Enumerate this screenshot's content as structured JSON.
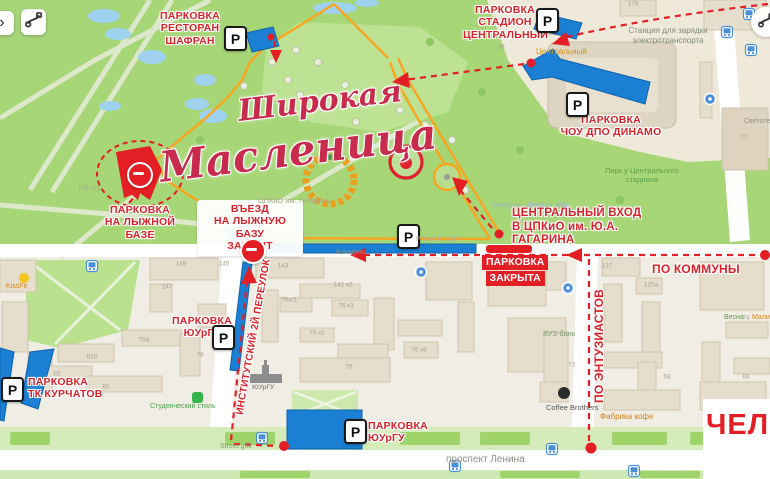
{
  "colors": {
    "annotation_red": "#d8232a",
    "parking_blue": "#1b7fd3",
    "route_orange": "#f9a51d",
    "park_green": "#a7d677",
    "closed_red": "#e31e24",
    "water_blue": "#9ed2ef"
  },
  "controls": {
    "chevron": "›"
  },
  "icons": {
    "parking": "P"
  },
  "logo": {
    "line1": "Широкая",
    "line2": "Масленица"
  },
  "annotations": {
    "parking_shafran": {
      "text": "ПАРКОВКА\nРЕСТОРАН\nШАФРАН"
    },
    "parking_stadium": {
      "text": "ПАРКОВКА\nСТАДИОН\nЦЕНТРАЛЬНЫЙ"
    },
    "parking_dinamo": {
      "text": "ПАРКОВКА\nЧОУ ДПО ДИНАМО"
    },
    "parking_ski": {
      "text": "ПАРКОВКА\nНА ЛЫЖНОЙ БАЗЕ"
    },
    "entry_closed": {
      "text": "ВЪЕЗД\nНА ЛЫЖНУЮ БАЗУ\nЗАКРЫТ"
    },
    "central_entrance": {
      "text": "ЦЕНТРАЛЬНЫЙ ВХОД\nВ ЦПКиО им. Ю.А. ГАГАРИНА"
    },
    "parking_closed": {
      "line1": "ПАРКОВКА",
      "line2": "ЗАКРЫТА"
    },
    "po_kommuny": {
      "text": "ПО КОММУНЫ"
    },
    "po_entuziastov": {
      "text": "ПО ЭНТУЗИАСТОВ"
    },
    "parking_susu_mid": {
      "text": "ПАРКОВКА\nЮУрГУ"
    },
    "institutskiy_lane": {
      "text": "ИНСТИТУТСКИЙ 2Й ПЕРЕУЛОК"
    },
    "parking_kurchatov": {
      "text": "ПАРКОВКА\nТК КУРЧАТОВ"
    },
    "parking_susu_bottom": {
      "text": "ПАРКОВКА\nЮУрГУ"
    }
  },
  "map_labels": {
    "charging_station": "Станция для зарядки\nэлектротранспорта",
    "stadium": "Центральный",
    "park_near_stadium": "Парк у Центрального\nстадиона",
    "cpkio": "ЦПКиО им. Гагарина",
    "zvezdnaya": "Звездная (Детская ж/д)",
    "kommuny": "Коммуны",
    "lenina": "проспект Ленина",
    "kissfit": "KissFit",
    "vuz_bank": "ВУЗ-банк",
    "coffee_brothers": "Coffee Brothers",
    "fabrika_kofe": "Фабрика кофе",
    "vesna": "Весна",
    "malina": "Малина",
    "svetotehnika": "Светотехника",
    "street_grill": "Street grill",
    "studencheskiy": "Студенческий стиль",
    "planet_english": "Planet English",
    "susu": "ЮУрГУ"
  },
  "building_numbers": [
    {
      "t": "179",
      "x": 633,
      "y": 4
    },
    {
      "t": "36",
      "x": 501,
      "y": 47
    },
    {
      "t": "22",
      "x": 744,
      "y": 137
    },
    {
      "t": "105 ст1",
      "x": 89,
      "y": 188
    },
    {
      "t": "149",
      "x": 181,
      "y": 264
    },
    {
      "t": "147",
      "x": 167,
      "y": 287
    },
    {
      "t": "145",
      "x": 224,
      "y": 264
    },
    {
      "t": "143",
      "x": 283,
      "y": 266
    },
    {
      "t": "141 к2",
      "x": 343,
      "y": 285
    },
    {
      "t": "137",
      "x": 607,
      "y": 266
    },
    {
      "t": "135а",
      "x": 651,
      "y": 285
    },
    {
      "t": "76а/1",
      "x": 289,
      "y": 300
    },
    {
      "t": "76 к3",
      "x": 346,
      "y": 306
    },
    {
      "t": "76 к2",
      "x": 317,
      "y": 333
    },
    {
      "t": "76 к8",
      "x": 419,
      "y": 350
    },
    {
      "t": "76",
      "x": 349,
      "y": 367
    },
    {
      "t": "78а",
      "x": 144,
      "y": 340
    },
    {
      "t": "82б",
      "x": 92,
      "y": 357
    },
    {
      "t": "82",
      "x": 57,
      "y": 374
    },
    {
      "t": "80",
      "x": 106,
      "y": 387
    },
    {
      "t": "78",
      "x": 200,
      "y": 355
    },
    {
      "t": "74",
      "x": 746,
      "y": 318
    },
    {
      "t": "72",
      "x": 572,
      "y": 365
    },
    {
      "t": "68",
      "x": 667,
      "y": 377
    },
    {
      "t": "66",
      "x": 746,
      "y": 377
    }
  ],
  "watermark": {
    "text": "ЧЕЛ"
  }
}
